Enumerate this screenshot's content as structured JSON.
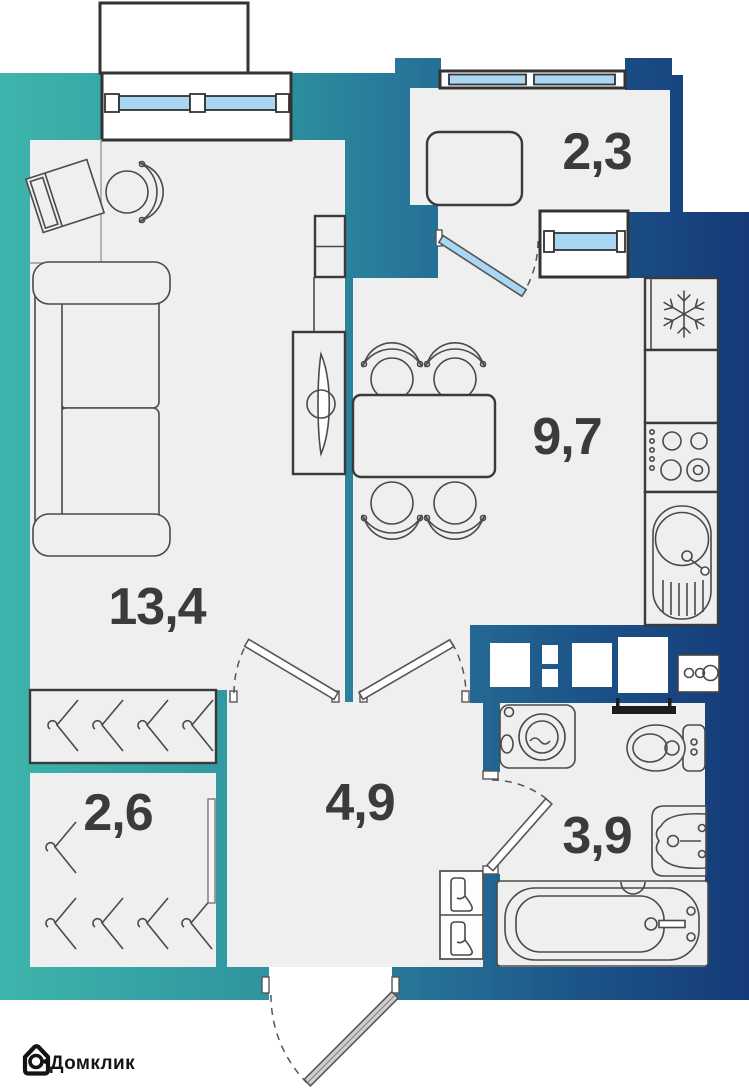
{
  "plan": {
    "type": "apartment-floor-plan",
    "rooms": {
      "living": {
        "area": "13,4"
      },
      "kitchen": {
        "area": "9,7"
      },
      "balcony": {
        "area": "2,3"
      },
      "wardrobe": {
        "area": "2,6"
      },
      "hallway": {
        "area": "4,9"
      },
      "bathroom": {
        "area": "3,9"
      }
    },
    "icons": [
      "snowflake-icon",
      "stove-burners-icon",
      "kitchen-sink-icon",
      "washing-machine-icon",
      "toilet-icon",
      "bathtub-icon",
      "bathroom-sink-icon",
      "towel-rail-icon",
      "hanger-icon",
      "boot-icon",
      "sofa-icon",
      "desk-icon",
      "chair-icon",
      "tv-icon",
      "dining-table-icon",
      "window-icon",
      "door-icon",
      "electrical-panel-icon"
    ]
  },
  "branding": {
    "logo_text": "Домклик"
  },
  "colors": {
    "wall_g1": "#3db5ac",
    "wall_g2": "#2f949f",
    "wall_g3": "#28799a",
    "wall_g4": "#1c5388",
    "wall_g5": "#153a79",
    "floor": "#efefef",
    "glass": "#a9d7f3",
    "line": "#4a4a4a",
    "label": "#3b3b3b",
    "logo": "#141414"
  }
}
